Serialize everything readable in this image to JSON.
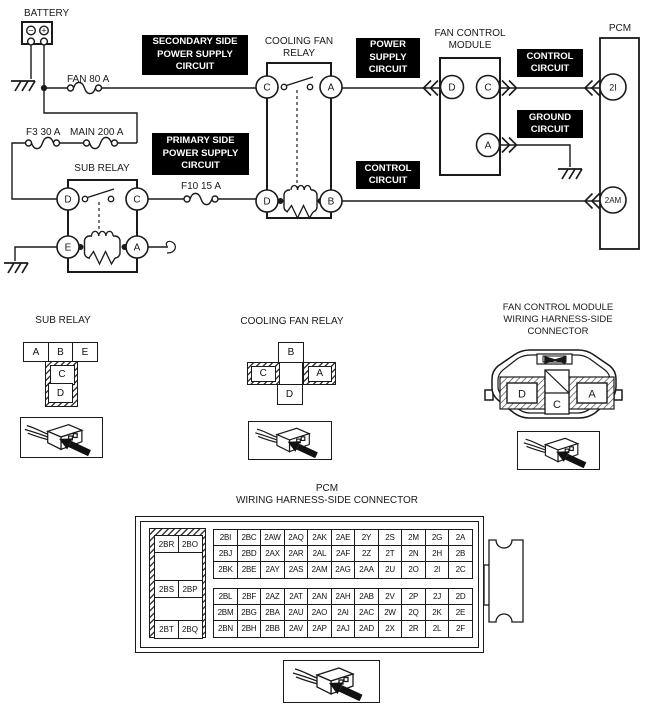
{
  "schematic": {
    "battery": {
      "label": "BATTERY",
      "minus": "−",
      "plus": "+"
    },
    "fuses": {
      "fan": "FAN 80 A",
      "f3": "F3 30 A",
      "main": "MAIN 200 A",
      "f10": "F10 15 A"
    },
    "black_labels": {
      "secondary": "SECONDARY SIDE\nPOWER SUPPLY\nCIRCUIT",
      "primary": "PRIMARY SIDE\nPOWER SUPPLY\nCIRCUIT",
      "power_supply": "POWER\nSUPPLY\nCIRCUIT",
      "control_top": "CONTROL\nCIRCUIT",
      "ground": "GROUND\nCIRCUIT",
      "control_bottom": "CONTROL\nCIRCUIT"
    },
    "sub_relay": {
      "title": "SUB RELAY",
      "d": "D",
      "c": "C",
      "e": "E",
      "a": "A"
    },
    "cooling_fan_relay": {
      "title": "COOLING FAN\nRELAY",
      "c": "C",
      "a": "A",
      "d": "D",
      "b": "B"
    },
    "fan_control_module": {
      "title": "FAN CONTROL\nMODULE",
      "d": "D",
      "c": "C",
      "a": "A"
    },
    "pcm": {
      "title": "PCM",
      "t_2i": "2I",
      "t_2am": "2AM"
    }
  },
  "connector_section": {
    "sub_relay": {
      "title": "SUB RELAY",
      "row": [
        "A",
        "B",
        "E"
      ],
      "c": "C",
      "d": "D"
    },
    "cooling_fan_relay": {
      "title": "COOLING FAN RELAY",
      "b": "B",
      "c": "C",
      "a": "A",
      "d": "D"
    },
    "fan_control_module": {
      "title": "FAN CONTROL MODULE\nWIRING HARNESS-SIDE\nCONNECTOR",
      "d": "D",
      "c": "C",
      "a": "A"
    },
    "pcm": {
      "title": "PCM\nWIRING HARNESS-SIDE CONNECTOR",
      "side_pairs": [
        [
          "2BR",
          "2BO"
        ],
        [
          "2BS",
          "2BP"
        ],
        [
          "2BT",
          "2BQ"
        ]
      ],
      "rows": [
        [
          "2BI",
          "2BC",
          "2AW",
          "2AQ",
          "2AK",
          "2AE",
          "2Y",
          "2S",
          "2M",
          "2G",
          "2A"
        ],
        [
          "2BJ",
          "2BD",
          "2AX",
          "2AR",
          "2AL",
          "2AF",
          "2Z",
          "2T",
          "2N",
          "2H",
          "2B"
        ],
        [
          "2BK",
          "2BE",
          "2AY",
          "2AS",
          "2AM",
          "2AG",
          "2AA",
          "2U",
          "2O",
          "2I",
          "2C"
        ],
        [
          "2BL",
          "2BF",
          "2AZ",
          "2AT",
          "2AN",
          "2AH",
          "2AB",
          "2V",
          "2P",
          "2J",
          "2D"
        ],
        [
          "2BM",
          "2BG",
          "2BA",
          "2AU",
          "2AO",
          "2AI",
          "2AC",
          "2W",
          "2Q",
          "2K",
          "2E"
        ],
        [
          "2BN",
          "2BH",
          "2BB",
          "2AV",
          "2AP",
          "2AJ",
          "2AD",
          "2X",
          "2R",
          "2L",
          "2F"
        ]
      ]
    }
  },
  "colors": {
    "line": "#1a1a1a",
    "label_bg": "#000000",
    "label_fg": "#ffffff"
  }
}
